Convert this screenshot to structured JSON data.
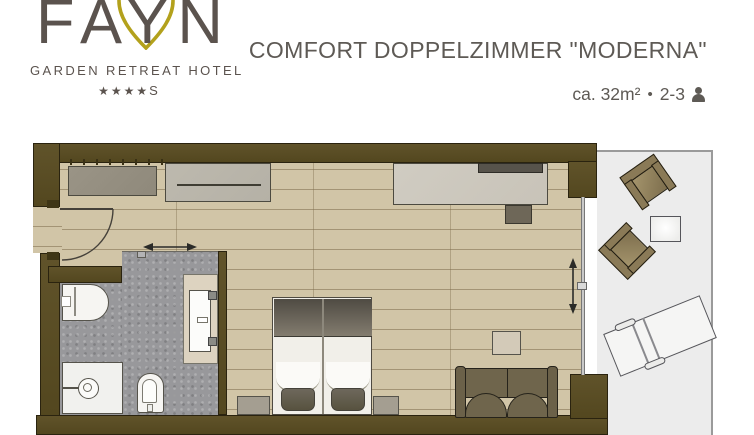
{
  "header": {
    "logo": {
      "brand": "FAYN",
      "tagline": "GARDEN RETREAT HOTEL",
      "stars": "★★★★",
      "stars_suffix": "S"
    },
    "title": "COMFORT DOPPELZIMMER \"MODERNA\"",
    "details": {
      "area": "ca. 32m²",
      "separator": "•",
      "occupancy": "2-3"
    }
  },
  "floorplan": {
    "elements": [
      "entrance-door",
      "wardrobe",
      "closet-rail-unit",
      "desk",
      "tv",
      "stool",
      "double-bed",
      "nightstand-left",
      "nightstand-right",
      "sofa",
      "side-table",
      "bathroom-sliding-door",
      "toilet",
      "shower",
      "wc",
      "washbasin-vanity",
      "balcony-sliding-door",
      "balcony-armchair-1",
      "balcony-armchair-2",
      "balcony-table",
      "sun-lounger"
    ]
  },
  "colors": {
    "logo_text": "#5b534e",
    "logo_gold": "#b3a11c",
    "title_text": "#5e5a55",
    "wall": "#53471f",
    "wall_light": "#60532a",
    "wall_edge": "#2a230f",
    "wall_dark": "#3f3616",
    "floor": "#d1c5a7",
    "bath_floor": "#98989b",
    "balcony": "#ececec",
    "window": "#c9c9c9",
    "fixture": "#f6f5f2",
    "line": "#55534b",
    "furn_gray_dark": "#8f897b",
    "furn_gray": "#b5b1a6",
    "desk": "#c8c3b8",
    "tv": "#57534b",
    "olive": "#6b6149",
    "olive_l": "#6f654c",
    "olive_dark": "#26231b",
    "wood_brown": "#8a7a57",
    "bed_frame": "#f1efe9",
    "blanket_dark": "#4f4b43",
    "blanket_light": "#837c6f",
    "pillow": "#6e685c",
    "nightstand": "#a49e91",
    "vanity": "#ddd3c0"
  }
}
